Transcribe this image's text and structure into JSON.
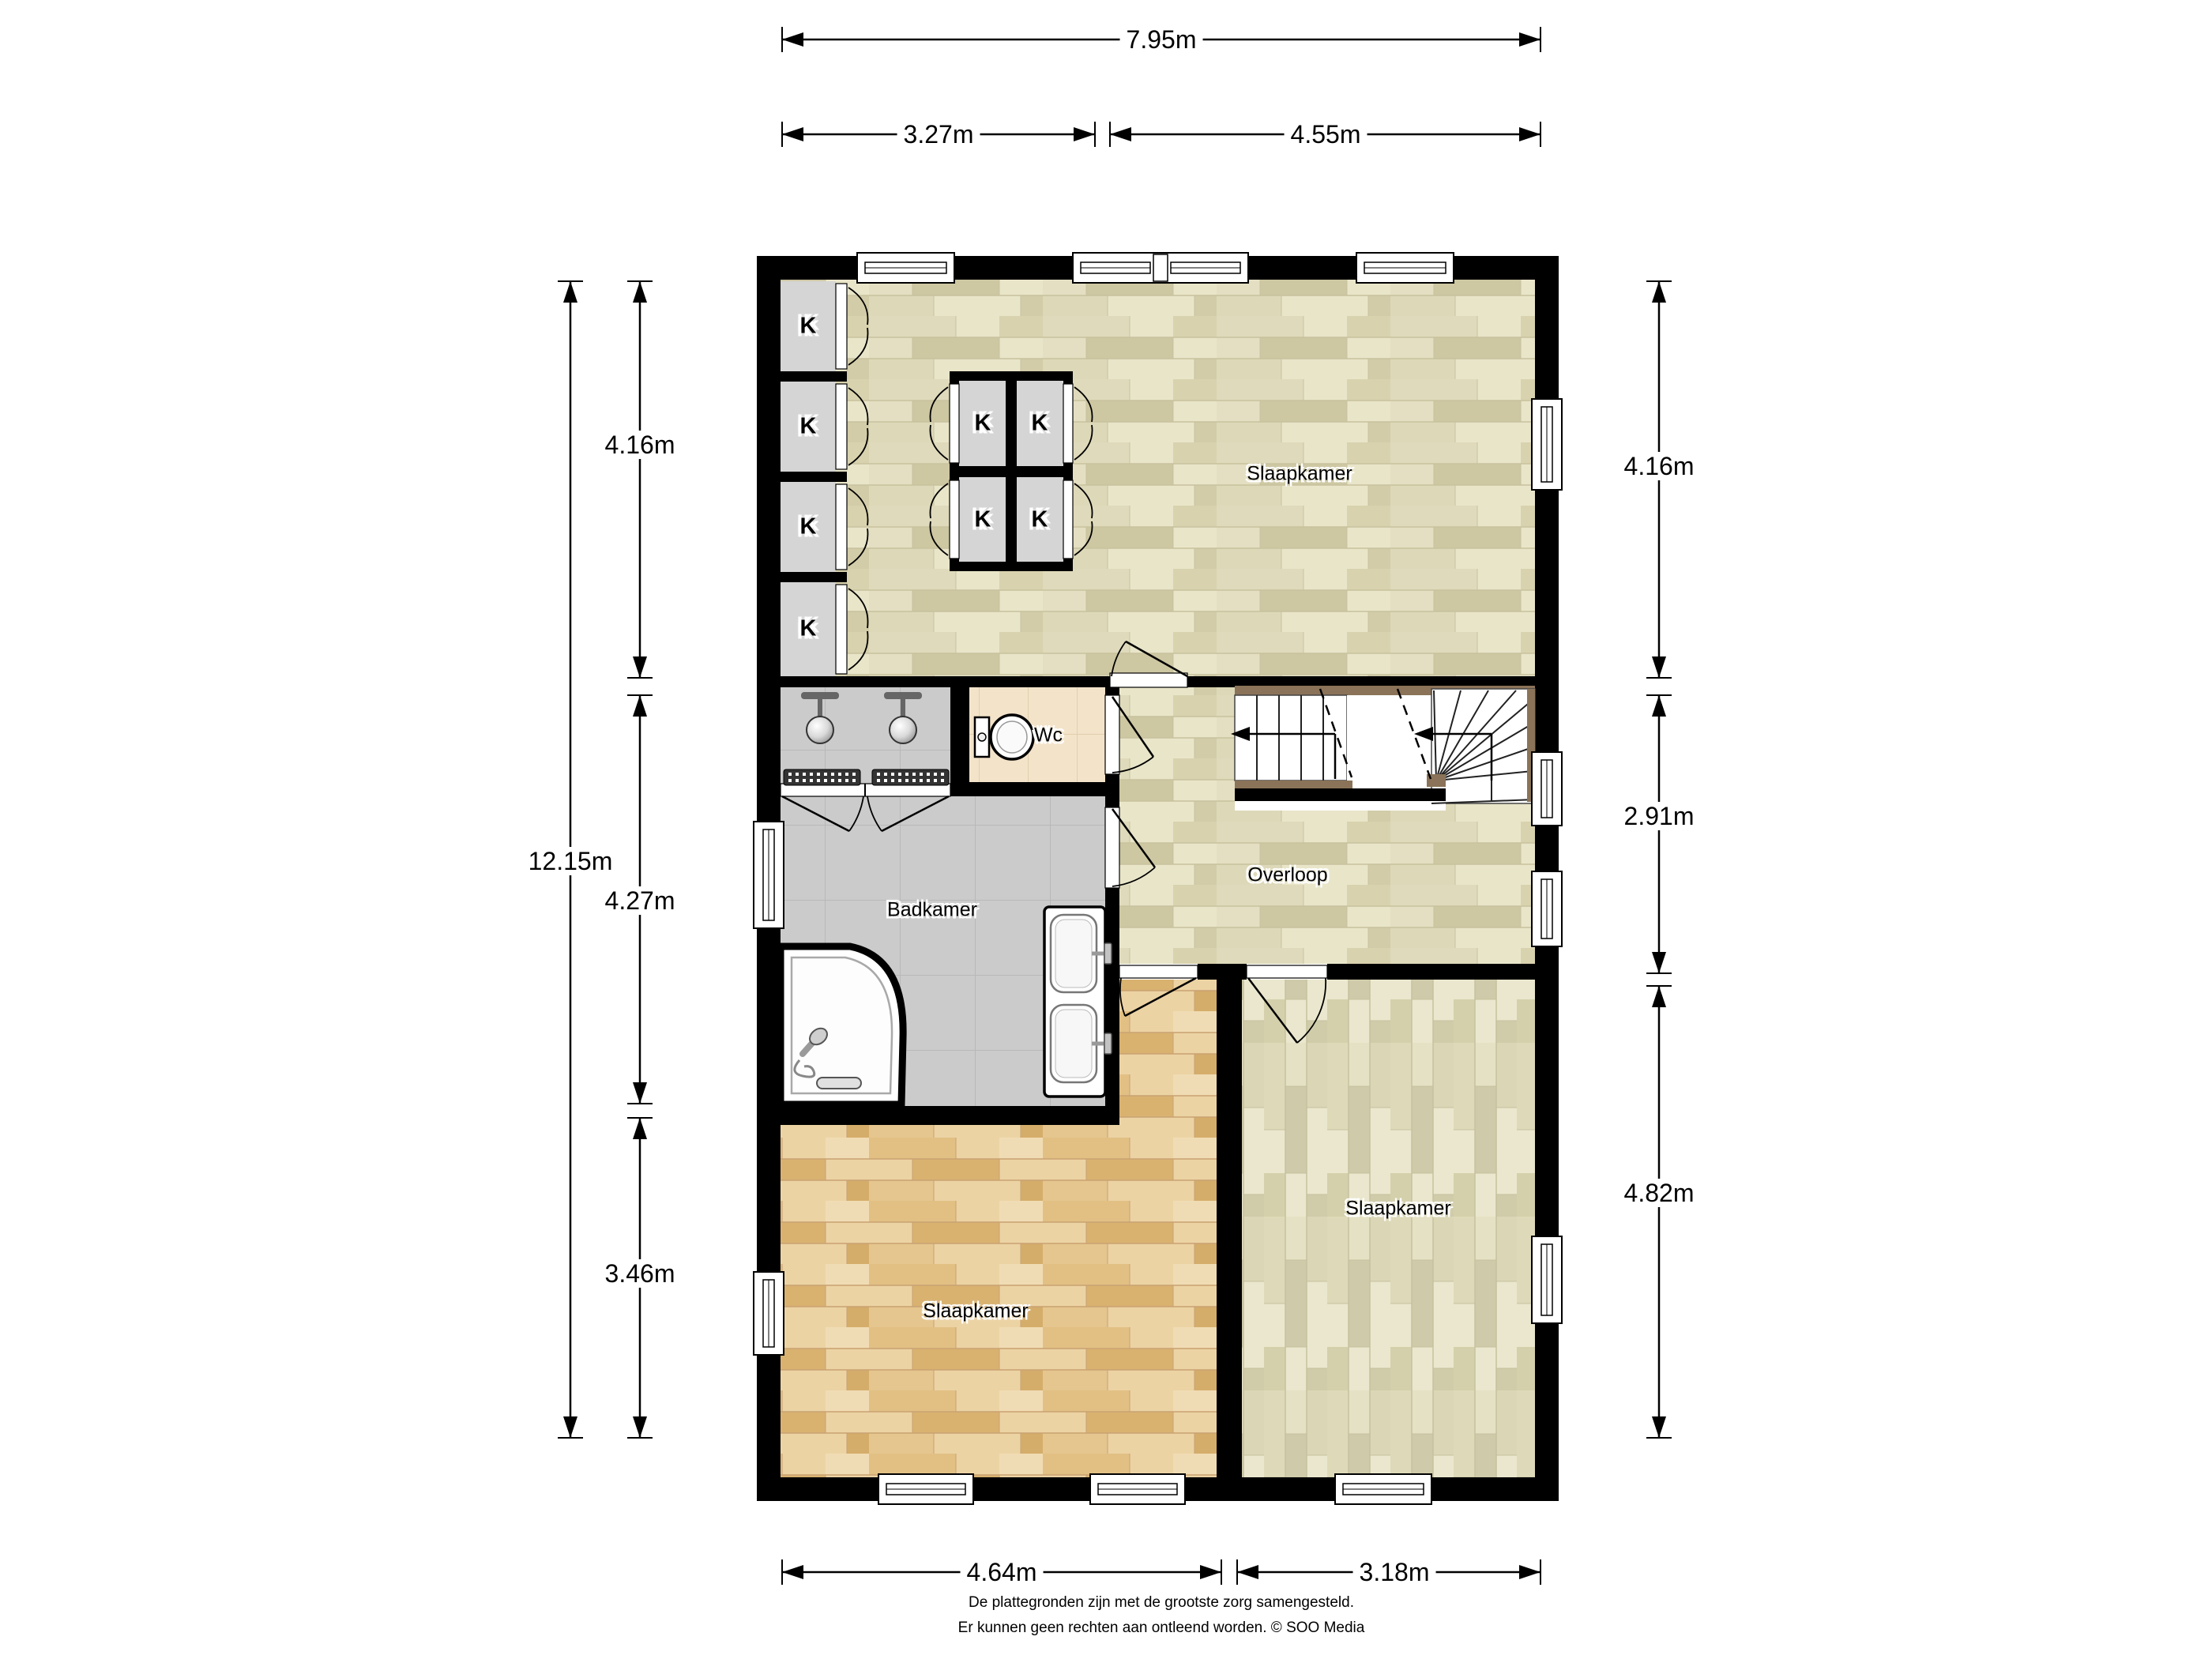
{
  "dimensions": {
    "top_total": "7.95m",
    "top_left": "3.27m",
    "top_right": "4.55m",
    "left_total": "12.15m",
    "left_top": "4.16m",
    "left_mid": "4.27m",
    "left_bottom": "3.46m",
    "right_top": "4.16m",
    "right_mid": "2.91m",
    "right_bottom": "4.82m",
    "bottom_left": "4.64m",
    "bottom_right": "3.18m"
  },
  "rooms": {
    "bedroom_top": "Slaapkamer",
    "wc": "Wc",
    "bathroom": "Badkamer",
    "landing": "Overloop",
    "bedroom_bottom_left": "Slaapkamer",
    "bedroom_bottom_right": "Slaapkamer"
  },
  "labels": {
    "closet": "K"
  },
  "footer": {
    "line1": "De plattegronden zijn met de grootste zorg samengesteld.",
    "line2": "Er kunnen geen rechten aan ontleend worden. © SOO Media"
  },
  "colors": {
    "wall": "#000000",
    "floor_wood_light": "#e9e5c9",
    "floor_wood_orange": "#ecd3a4",
    "floor_wood_pale": "#eae7ce",
    "floor_tile_gray": "#cbcbcb",
    "floor_tile_beige": "#f3e3c9",
    "stair_stringer": "#8a7358"
  }
}
